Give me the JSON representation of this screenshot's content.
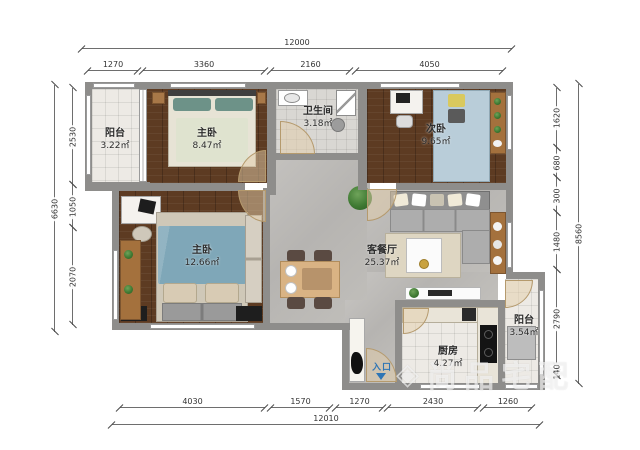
{
  "watermark": {
    "logo": "◈",
    "text": "尚品宅配"
  },
  "rooms": [
    {
      "id": "balcony-top",
      "name": "阳台",
      "area": "3.22㎡"
    },
    {
      "id": "master-top",
      "name": "主卧",
      "area": "8.47㎡"
    },
    {
      "id": "bathroom",
      "name": "卫生间",
      "area": "3.18㎡"
    },
    {
      "id": "second-bedroom",
      "name": "次卧",
      "area": "9.65㎡"
    },
    {
      "id": "master-bottom",
      "name": "主卧",
      "area": "12.66㎡"
    },
    {
      "id": "living-dining",
      "name": "客餐厅",
      "area": "25.37㎡"
    },
    {
      "id": "kitchen",
      "name": "厨房",
      "area": "4.27㎡"
    },
    {
      "id": "balcony-bottom",
      "name": "阳台",
      "area": "3.54㎡"
    }
  ],
  "entrance": {
    "label": "入口"
  },
  "dimensions": {
    "top": {
      "total": "12000",
      "segments": [
        "1270",
        "3360",
        "2160",
        "4050"
      ]
    },
    "bottom": {
      "total": "12010",
      "segments": [
        "4030",
        "1570",
        "1270",
        "2430",
        "1260"
      ]
    },
    "left": {
      "total": "6630",
      "segments": [
        "2530",
        "1050",
        "2070"
      ]
    },
    "right": {
      "total": "8560",
      "segments": [
        "1620",
        "680",
        "300",
        "1480",
        "2790",
        "140"
      ]
    }
  },
  "colors": {
    "wall": "#8e8d8b",
    "wood_floor": "#5d3b22",
    "stone_floor": "#bcbab7",
    "tile_floor": "#edeae5",
    "bath_tile": "#d9d7d3",
    "entry_accent": "#2e75b5",
    "bed_blue": "#7fa7b8",
    "bed_light_blue": "#b9cdd9",
    "door_swing": "#d9c0a0"
  }
}
